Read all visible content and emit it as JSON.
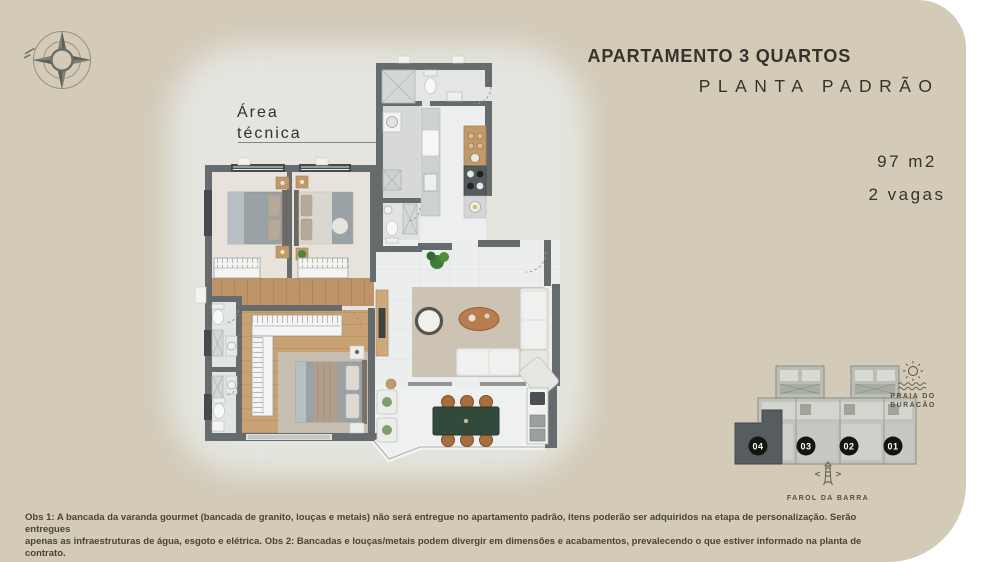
{
  "colors": {
    "panel": "#d3cab8",
    "wall": "#666c6e",
    "wood": "#c9a173",
    "dining_table_green": "#314a3c",
    "text_dark": "#34332d",
    "highlight_unit": "#575d5f"
  },
  "header": {
    "line1": "APARTAMENTO 3 QUARTOS",
    "line2": "PLANTA PADRÃO"
  },
  "unit_info": {
    "area": "97 m2",
    "parking": "2 vagas"
  },
  "callout": {
    "line1": "Área",
    "line2": "técnica"
  },
  "key_plan": {
    "units": [
      {
        "label": "04",
        "highlighted": true
      },
      {
        "label": "03",
        "highlighted": false
      },
      {
        "label": "02",
        "highlighted": false
      },
      {
        "label": "01",
        "highlighted": false
      }
    ],
    "landmark_beach": {
      "line1": "PRAIA DO",
      "line2": "BURACÃO"
    },
    "landmark_lighthouse": "FAROL DA BARRA"
  },
  "disclaimer": {
    "line1": "Obs 1: A bancada da varanda gourmet (bancada de granito, louças e metais) não será entregue no apartamento padrão, itens poderão ser adquiridos na etapa de personalização. Serão entregues",
    "line2": "apenas as infraestruturas de água, esgoto e elétrica. Obs 2: Bancadas e louças/metais podem divergir em dimensões e acabamentos, prevalecendo o que estiver informado na planta de contrato."
  },
  "icons": {
    "compass": "compass-rose",
    "beach": "sun-over-waves",
    "lighthouse": "lighthouse"
  }
}
